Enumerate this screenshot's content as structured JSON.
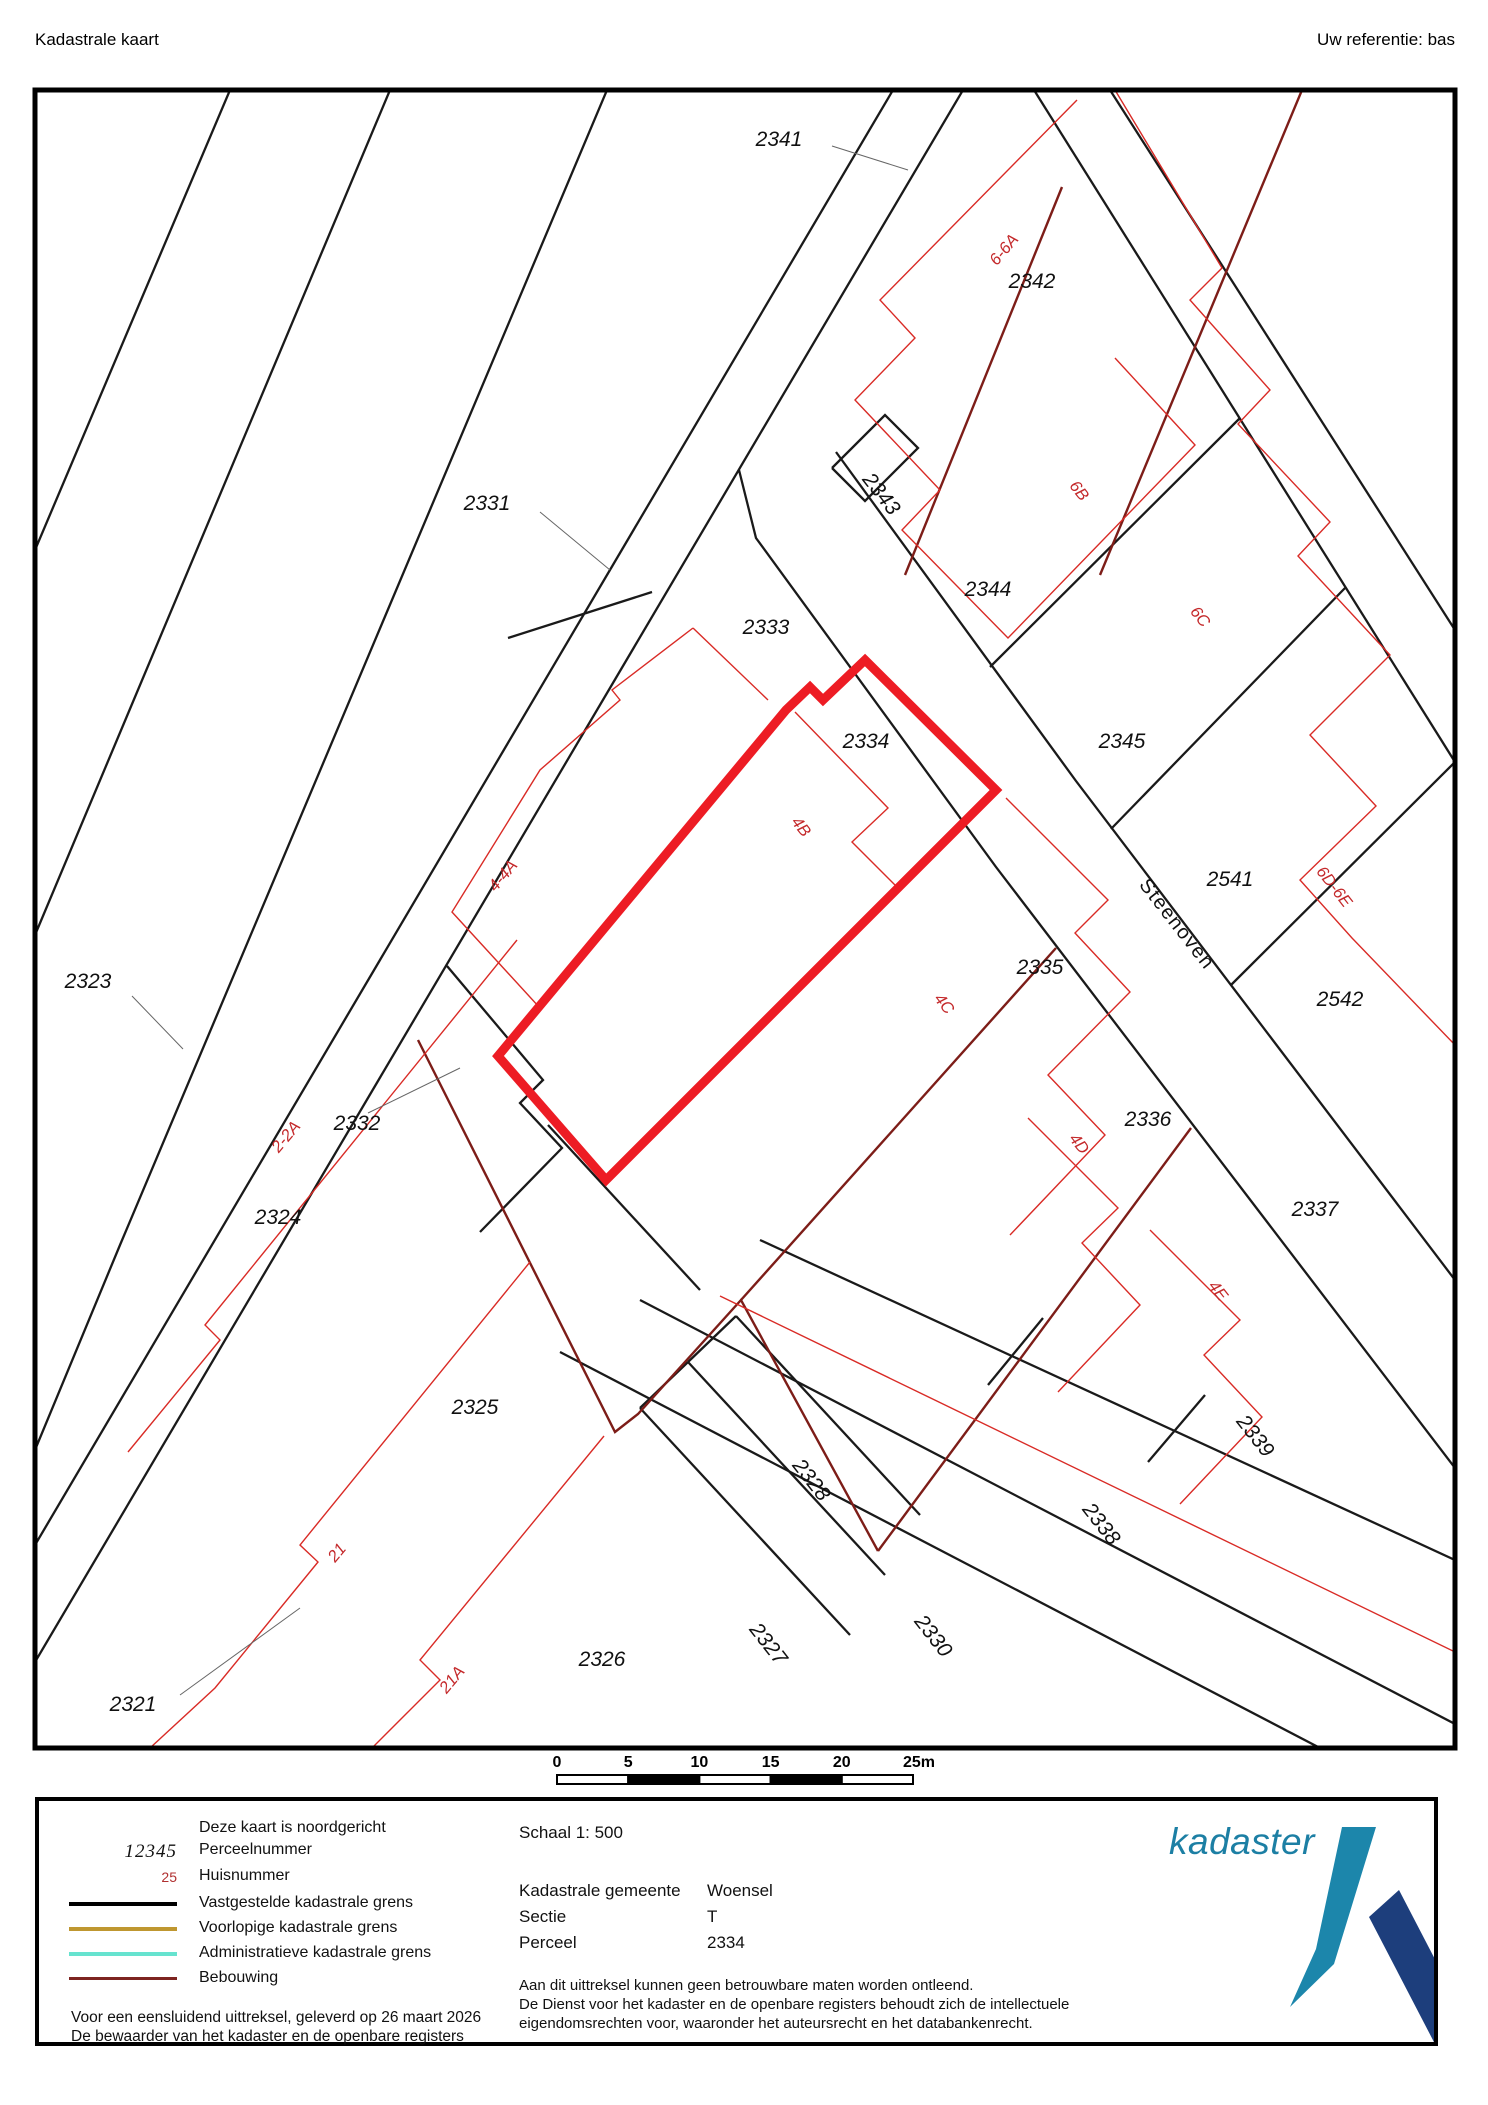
{
  "header": {
    "title": "Kadastrale kaart",
    "reference": "Uw referentie: bas"
  },
  "map": {
    "border": {
      "x": 35,
      "y": 90,
      "w": 1420,
      "h": 1658
    },
    "colors": {
      "boundary": "#1a1a1a",
      "building_thin": "#d92b26",
      "building_dark": "#7d1d18",
      "highlight": "#ed1c24",
      "leader": "#666666",
      "label_black": "#111111",
      "label_red": "#c4292b"
    },
    "highlight_parcel": {
      "number": "2334",
      "points": [
        865,
        660,
        996,
        790,
        606,
        1180,
        498,
        1056,
        786,
        710,
        810,
        687,
        823,
        700
      ]
    },
    "lines_black": [
      [
        893,
        90,
        35,
        1545
      ],
      [
        963,
        90,
        35,
        1662
      ],
      [
        652,
        592,
        508,
        638
      ],
      [
        607,
        90,
        120,
        1245,
        35,
        1450
      ],
      [
        390,
        90,
        35,
        935
      ],
      [
        230,
        90,
        35,
        550
      ],
      [
        739,
        470,
        756,
        538,
        996,
        867,
        1455,
        1468
      ],
      [
        836,
        452,
        1076,
        781,
        1455,
        1280
      ],
      [
        1034,
        90,
        1455,
        762
      ],
      [
        1110,
        90,
        1455,
        630
      ],
      [
        990,
        667,
        1240,
        418
      ],
      [
        1111,
        829,
        1345,
        588
      ],
      [
        1231,
        985,
        1455,
        762
      ],
      [
        832,
        468,
        885,
        415,
        918,
        448,
        865,
        501,
        832,
        468
      ],
      [
        640,
        1300,
        1455,
        1724
      ],
      [
        560,
        1352,
        1320,
        1748
      ],
      [
        760,
        1240,
        1455,
        1560
      ],
      [
        1205,
        1395,
        1148,
        1462
      ],
      [
        1043,
        1318,
        988,
        1385
      ],
      [
        640,
        1408,
        850,
        1635
      ],
      [
        688,
        1362,
        885,
        1575
      ],
      [
        736,
        1316,
        920,
        1515
      ],
      [
        640,
        1408,
        688,
        1362
      ],
      [
        688,
        1362,
        736,
        1316
      ],
      [
        447,
        966,
        543,
        1080,
        520,
        1103,
        562,
        1148,
        480,
        1232
      ],
      [
        548,
        1125,
        700,
        1290
      ]
    ],
    "lines_dark": [
      [
        418,
        1040,
        615,
        1432,
        638,
        1414,
        741,
        1300,
        878,
        1551
      ],
      [
        878,
        1551,
        1191,
        1128
      ],
      [
        741,
        1300,
        1056,
        948
      ],
      [
        1062,
        187,
        905,
        575
      ],
      [
        1302,
        90,
        1100,
        575
      ]
    ],
    "lines_red": [
      [
        693,
        628,
        612,
        690,
        620,
        700,
        540,
        770,
        452,
        912,
        540,
        1008,
        498,
        1056
      ],
      [
        693,
        628,
        768,
        700
      ],
      [
        795,
        712,
        888,
        808,
        852,
        842,
        898,
        888,
        998,
        790
      ],
      [
        1006,
        798,
        1108,
        900,
        1075,
        933,
        1130,
        992,
        1048,
        1075,
        1105,
        1135,
        1010,
        1235
      ],
      [
        1028,
        1118,
        1118,
        1208,
        1082,
        1243,
        1140,
        1305,
        1058,
        1392
      ],
      [
        1150,
        1230,
        1240,
        1320,
        1204,
        1355,
        1262,
        1417,
        1180,
        1504
      ],
      [
        1077,
        100,
        880,
        300,
        915,
        338,
        855,
        400,
        940,
        490,
        902,
        530,
        1008,
        638,
        1195,
        445,
        1115,
        358
      ],
      [
        1115,
        90,
        1222,
        268,
        1190,
        300,
        1270,
        390,
        1238,
        424,
        1330,
        522,
        1298,
        556,
        1390,
        655,
        1310,
        735,
        1376,
        806,
        1300,
        880,
        1352,
        938,
        1455,
        1045
      ],
      [
        517,
        940,
        205,
        1325,
        220,
        1340,
        128,
        1452
      ],
      [
        530,
        1262,
        300,
        1545,
        318,
        1562,
        215,
        1688,
        150,
        1748
      ],
      [
        604,
        1436,
        420,
        1660,
        440,
        1680,
        372,
        1748
      ],
      [
        720,
        1296,
        1455,
        1652
      ]
    ],
    "leaders": [
      [
        832,
        146,
        908,
        170
      ],
      [
        540,
        512,
        610,
        570
      ],
      [
        132,
        996,
        183,
        1049
      ],
      [
        368,
        1113,
        460,
        1068
      ],
      [
        180,
        1695,
        300,
        1608
      ]
    ],
    "labels_black": [
      {
        "text": "2341",
        "x": 779,
        "y": 146,
        "rot": 0
      },
      {
        "text": "2342",
        "x": 1032,
        "y": 288,
        "rot": 0
      },
      {
        "text": "2343",
        "x": 876,
        "y": 498,
        "rot": 52
      },
      {
        "text": "2344",
        "x": 988,
        "y": 596,
        "rot": 0
      },
      {
        "text": "2345",
        "x": 1122,
        "y": 748,
        "rot": 0
      },
      {
        "text": "2541",
        "x": 1230,
        "y": 886,
        "rot": 0
      },
      {
        "text": "2542",
        "x": 1340,
        "y": 1006,
        "rot": 0
      },
      {
        "text": "2331",
        "x": 487,
        "y": 510,
        "rot": 0
      },
      {
        "text": "2333",
        "x": 766,
        "y": 634,
        "rot": 0
      },
      {
        "text": "2334",
        "x": 866,
        "y": 748,
        "rot": 0
      },
      {
        "text": "2335",
        "x": 1040,
        "y": 974,
        "rot": 0
      },
      {
        "text": "2336",
        "x": 1148,
        "y": 1126,
        "rot": 0
      },
      {
        "text": "2337",
        "x": 1315,
        "y": 1216,
        "rot": 0
      },
      {
        "text": "2323",
        "x": 88,
        "y": 988,
        "rot": 0
      },
      {
        "text": "2332",
        "x": 357,
        "y": 1130,
        "rot": 0
      },
      {
        "text": "2324",
        "x": 278,
        "y": 1224,
        "rot": 0
      },
      {
        "text": "2325",
        "x": 475,
        "y": 1414,
        "rot": 0
      },
      {
        "text": "2326",
        "x": 602,
        "y": 1666,
        "rot": 0
      },
      {
        "text": "2321",
        "x": 133,
        "y": 1711,
        "rot": 0
      },
      {
        "text": "2327",
        "x": 763,
        "y": 1648,
        "rot": 52
      },
      {
        "text": "2328",
        "x": 806,
        "y": 1484,
        "rot": 52
      },
      {
        "text": "2330",
        "x": 928,
        "y": 1640,
        "rot": 52
      },
      {
        "text": "2338",
        "x": 1096,
        "y": 1528,
        "rot": 52
      },
      {
        "text": "2339",
        "x": 1250,
        "y": 1440,
        "rot": 52
      }
    ],
    "labels_red": [
      {
        "text": "6-6A",
        "x": 1008,
        "y": 253,
        "rot": -50
      },
      {
        "text": "6B",
        "x": 1075,
        "y": 494,
        "rot": 52
      },
      {
        "text": "6C",
        "x": 1196,
        "y": 620,
        "rot": 52
      },
      {
        "text": "6D-6E",
        "x": 1330,
        "y": 890,
        "rot": 52
      },
      {
        "text": "4-4A",
        "x": 507,
        "y": 879,
        "rot": -50
      },
      {
        "text": "4B",
        "x": 797,
        "y": 830,
        "rot": 52
      },
      {
        "text": "4C",
        "x": 940,
        "y": 1007,
        "rot": 52
      },
      {
        "text": "4D",
        "x": 1075,
        "y": 1147,
        "rot": 52
      },
      {
        "text": "4E",
        "x": 1214,
        "y": 1294,
        "rot": 52
      },
      {
        "text": "2-2A",
        "x": 290,
        "y": 1140,
        "rot": -50
      },
      {
        "text": "21",
        "x": 341,
        "y": 1556,
        "rot": -50
      },
      {
        "text": "21A",
        "x": 456,
        "y": 1683,
        "rot": -50
      }
    ],
    "street_label": {
      "text": "Steenoven",
      "x": 1172,
      "y": 928,
      "rot": 52
    }
  },
  "scalebar": {
    "x": 557,
    "y": 1775,
    "seg_w": 71.2,
    "h": 9,
    "labels": [
      "0",
      "5",
      "10",
      "15",
      "20",
      "25m"
    ]
  },
  "legend": {
    "north_note": "Deze kaart is noordgericht",
    "perceel_sample": "12345",
    "perceel_label": "Perceelnummer",
    "huis_sample": "25",
    "huis_label": "Huisnummer",
    "swatches": [
      {
        "color": "#000000",
        "label": "Vastgestelde kadastrale grens"
      },
      {
        "color": "#bf9730",
        "label": "Voorlopige kadastrale grens"
      },
      {
        "color": "#66e3cf",
        "label": "Administratieve kadastrale grens"
      },
      {
        "color": "#7d2420",
        "label": "Bebouwing"
      }
    ],
    "footer_line1": "Voor een eensluidend uittreksel, geleverd op 26 maart 2026",
    "footer_line2": "De bewaarder van het kadaster en de openbare registers"
  },
  "info": {
    "schaal": "Schaal 1: 500",
    "rows": [
      {
        "label": "Kadastrale gemeente",
        "value": "Woensel"
      },
      {
        "label": "Sectie",
        "value": "T"
      },
      {
        "label": "Perceel",
        "value": "2334"
      }
    ],
    "disclaimer": [
      "Aan dit uittreksel kunnen geen betrouwbare maten worden ontleend.",
      "De Dienst voor het kadaster en de openbare registers behoudt zich de intellectuele",
      "eigendomsrechten voor, waaronder het auteursrecht en het databankenrecht."
    ]
  },
  "logo": {
    "text": "kadaster",
    "teal": "#1c86ab",
    "navy": "#1d3e7c"
  }
}
